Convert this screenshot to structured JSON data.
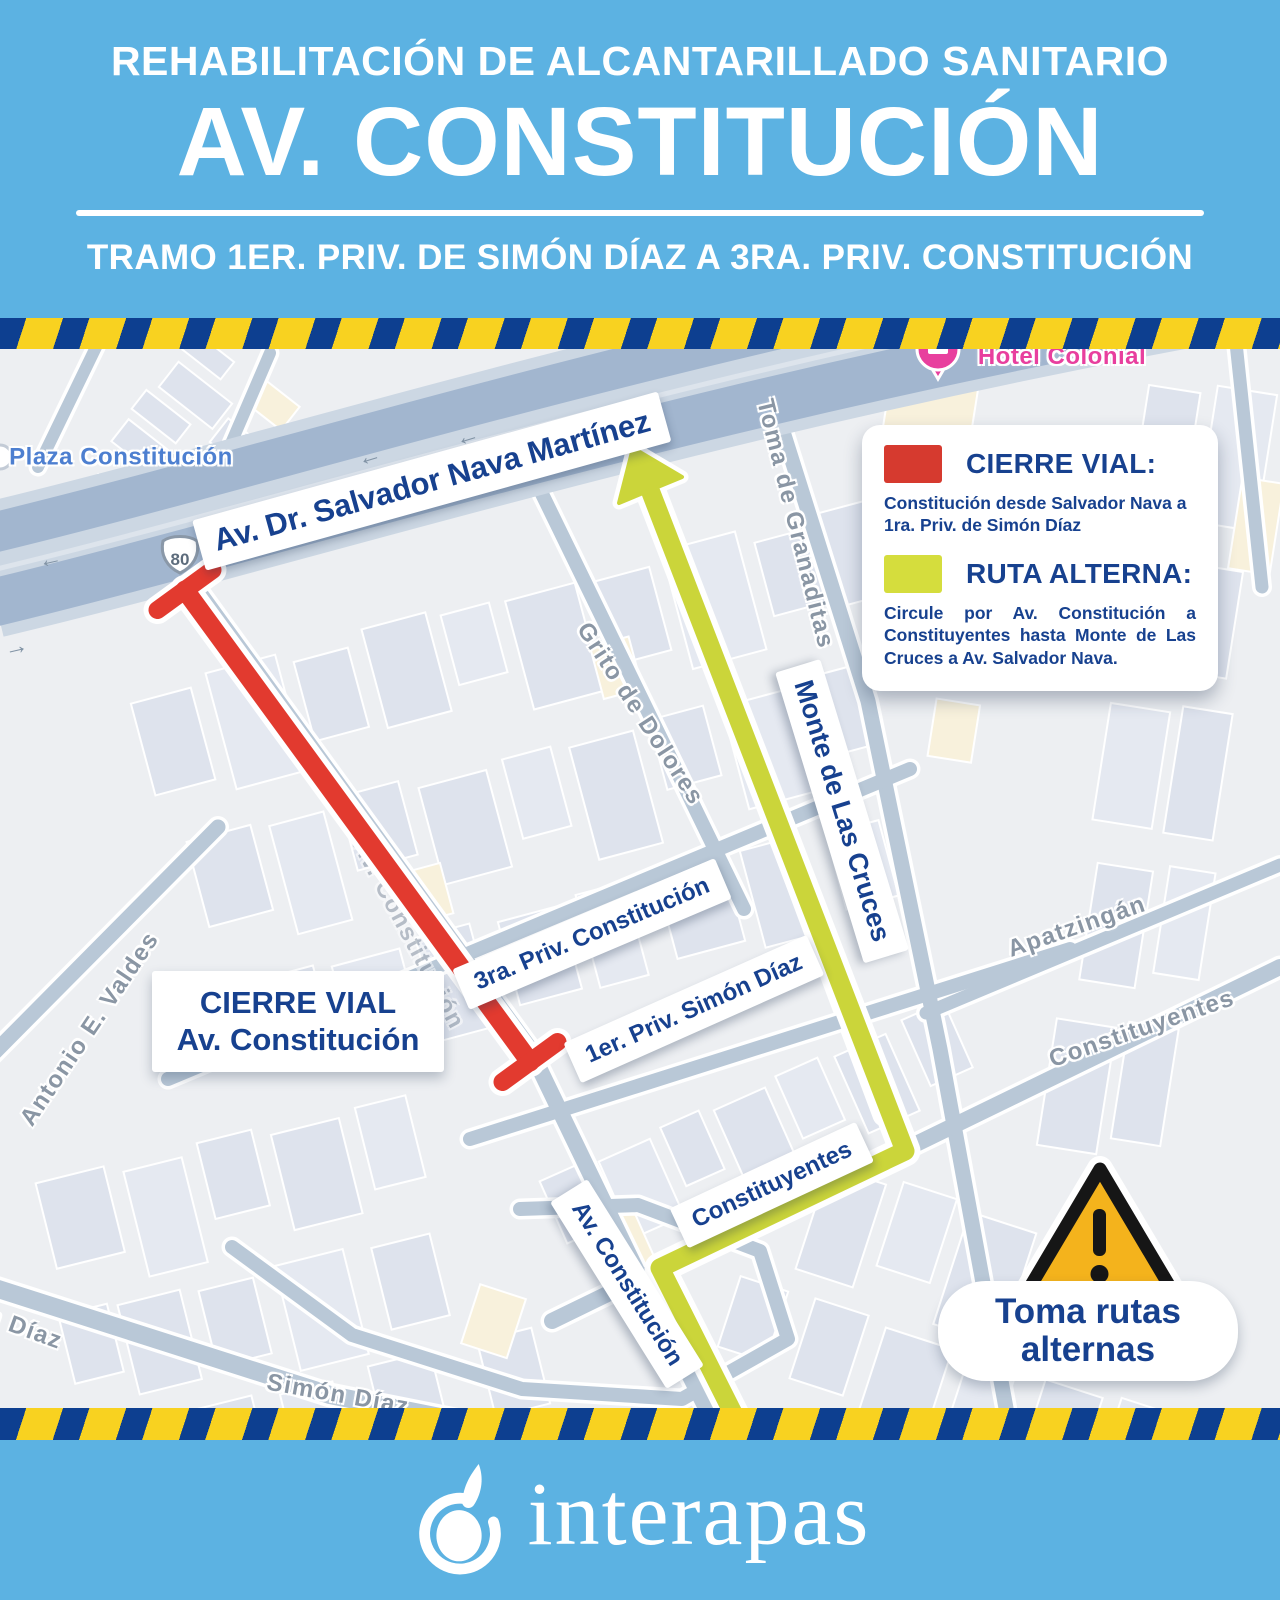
{
  "header": {
    "line1": "REHABILITACIÓN DE ALCANTARILLADO SANITARIO",
    "title": "AV. CONSTITUCIÓN",
    "subtitle": "TRAMO 1ER. PRIV. DE SIMÓN DÍAZ A 3RA. PRIV. CONSTITUCIÓN"
  },
  "legend": {
    "closure_title": "CIERRE VIAL:",
    "closure_text": "Constitución desde Salvador Nava a 1ra. Priv. de Simón Díaz",
    "alternate_title": "RUTA ALTERNA:",
    "alternate_text": "Circule por Av. Constitución a Constituyentes hasta Monte de Las Cruces a Av. Salvador Nava."
  },
  "map": {
    "highway_shield": "80",
    "poi": {
      "plaza": "Plaza Constitución",
      "hotel": "Hotel Colonial"
    },
    "street_tags": {
      "salvador_nava": "Av. Dr. Salvador Nava Martínez",
      "tercera_priv": "3ra. Priv. Constitución",
      "primera_priv": "1er. Priv. Simón Díaz",
      "monte_cruces": "Monte de Las Cruces",
      "av_constitucion": "Av. Constitución",
      "constituyentes": "Constituyentes"
    },
    "street_labels": {
      "granaditas": "Toma de Granaditas",
      "grito_dolores": "Grito de Dolores",
      "valdes": "Antonio E. Valdes",
      "apatzingan": "Apatzingán",
      "constituyentes": "Constituyentes",
      "simon_diaz": "Simón Díaz",
      "simon_diaz_partial": "n Díaz",
      "av_constitucion": "Av. Constitución"
    },
    "closure_label": {
      "line1": "CIERRE VIAL",
      "line2": "Av. Constitución"
    },
    "warning": {
      "line1": "Toma rutas",
      "line2": "alternas"
    }
  },
  "footer": {
    "brand": "interapas"
  },
  "colors": {
    "header_bg": "#5cb2e2",
    "tape_blue": "#0d3f90",
    "tape_yellow": "#f8d220",
    "closure_red": "#e23a2f",
    "alternate_green": "#cbd53a",
    "text_blue": "#17418f",
    "warning_amber": "#f4b31c",
    "hotel_pink": "#e83f9e",
    "maps_label_blue": "#4d7fd0"
  }
}
